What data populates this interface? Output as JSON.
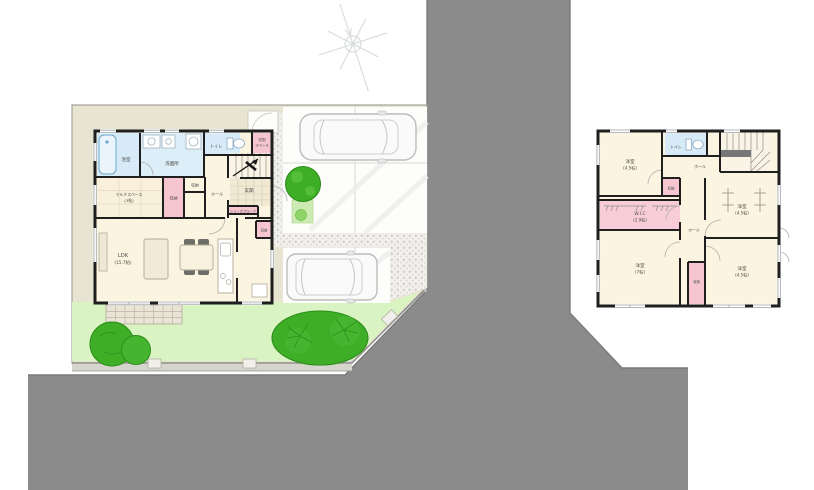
{
  "colors": {
    "road": "#8b8b8b",
    "road_edge": "#7b7b7b",
    "lot_ground": "#e7e5d2",
    "lawn": "#daf3c2",
    "tree_green": "#3fae27",
    "tree_dark": "#2c8c1c",
    "wall_black": "#1f1f1f",
    "room_cream": "#fbf4e0",
    "wet_room_blue": "#d6ebf7",
    "storage_pink": "#f5c5d0",
    "wic_pink": "#f8cdd9",
    "cobblestone": "#f1f0ec",
    "concrete_white": "#fdfdfc"
  },
  "compass": {
    "icon": "north-compass"
  },
  "floor1": {
    "rooms": {
      "bath": {
        "label": "浴室"
      },
      "washroom": {
        "label": "洗面所"
      },
      "toilet": {
        "label": "トイレ"
      },
      "delivery_space": {
        "line1": "宅配",
        "line2": "スペース"
      },
      "multi_space": {
        "line1": "マルチスペース",
        "line2": "(3帖)"
      },
      "storage_a": {
        "label": "収納"
      },
      "storage_b": {
        "label": "収納"
      },
      "hall": {
        "label": "ホール"
      },
      "entrance": {
        "label": "玄関"
      },
      "shoe_closet": {
        "label": "シューズクローク"
      },
      "storage_c": {
        "label": "収納"
      },
      "ldk": {
        "line1": "LDK",
        "line2": "(15.7帖)"
      }
    }
  },
  "floor2": {
    "rooms": {
      "bedroom_nw": {
        "line1": "洋室",
        "line2": "(4.5帖)"
      },
      "toilet": {
        "label": "トイレ"
      },
      "hall_upper": {
        "label": "ホール"
      },
      "storage_a": {
        "label": "収納"
      },
      "bedroom_e": {
        "line1": "洋室",
        "line2": "(4.5帖)"
      },
      "wic": {
        "line1": "W.I.C",
        "line2": "(2.9帖)"
      },
      "hall_lower": {
        "label": "ホール"
      },
      "bedroom_sw": {
        "line1": "洋室",
        "line2": "(7帖)"
      },
      "storage_b": {
        "label": "収納"
      },
      "bedroom_se": {
        "line1": "洋室",
        "line2": "(4.5帖)"
      }
    }
  }
}
